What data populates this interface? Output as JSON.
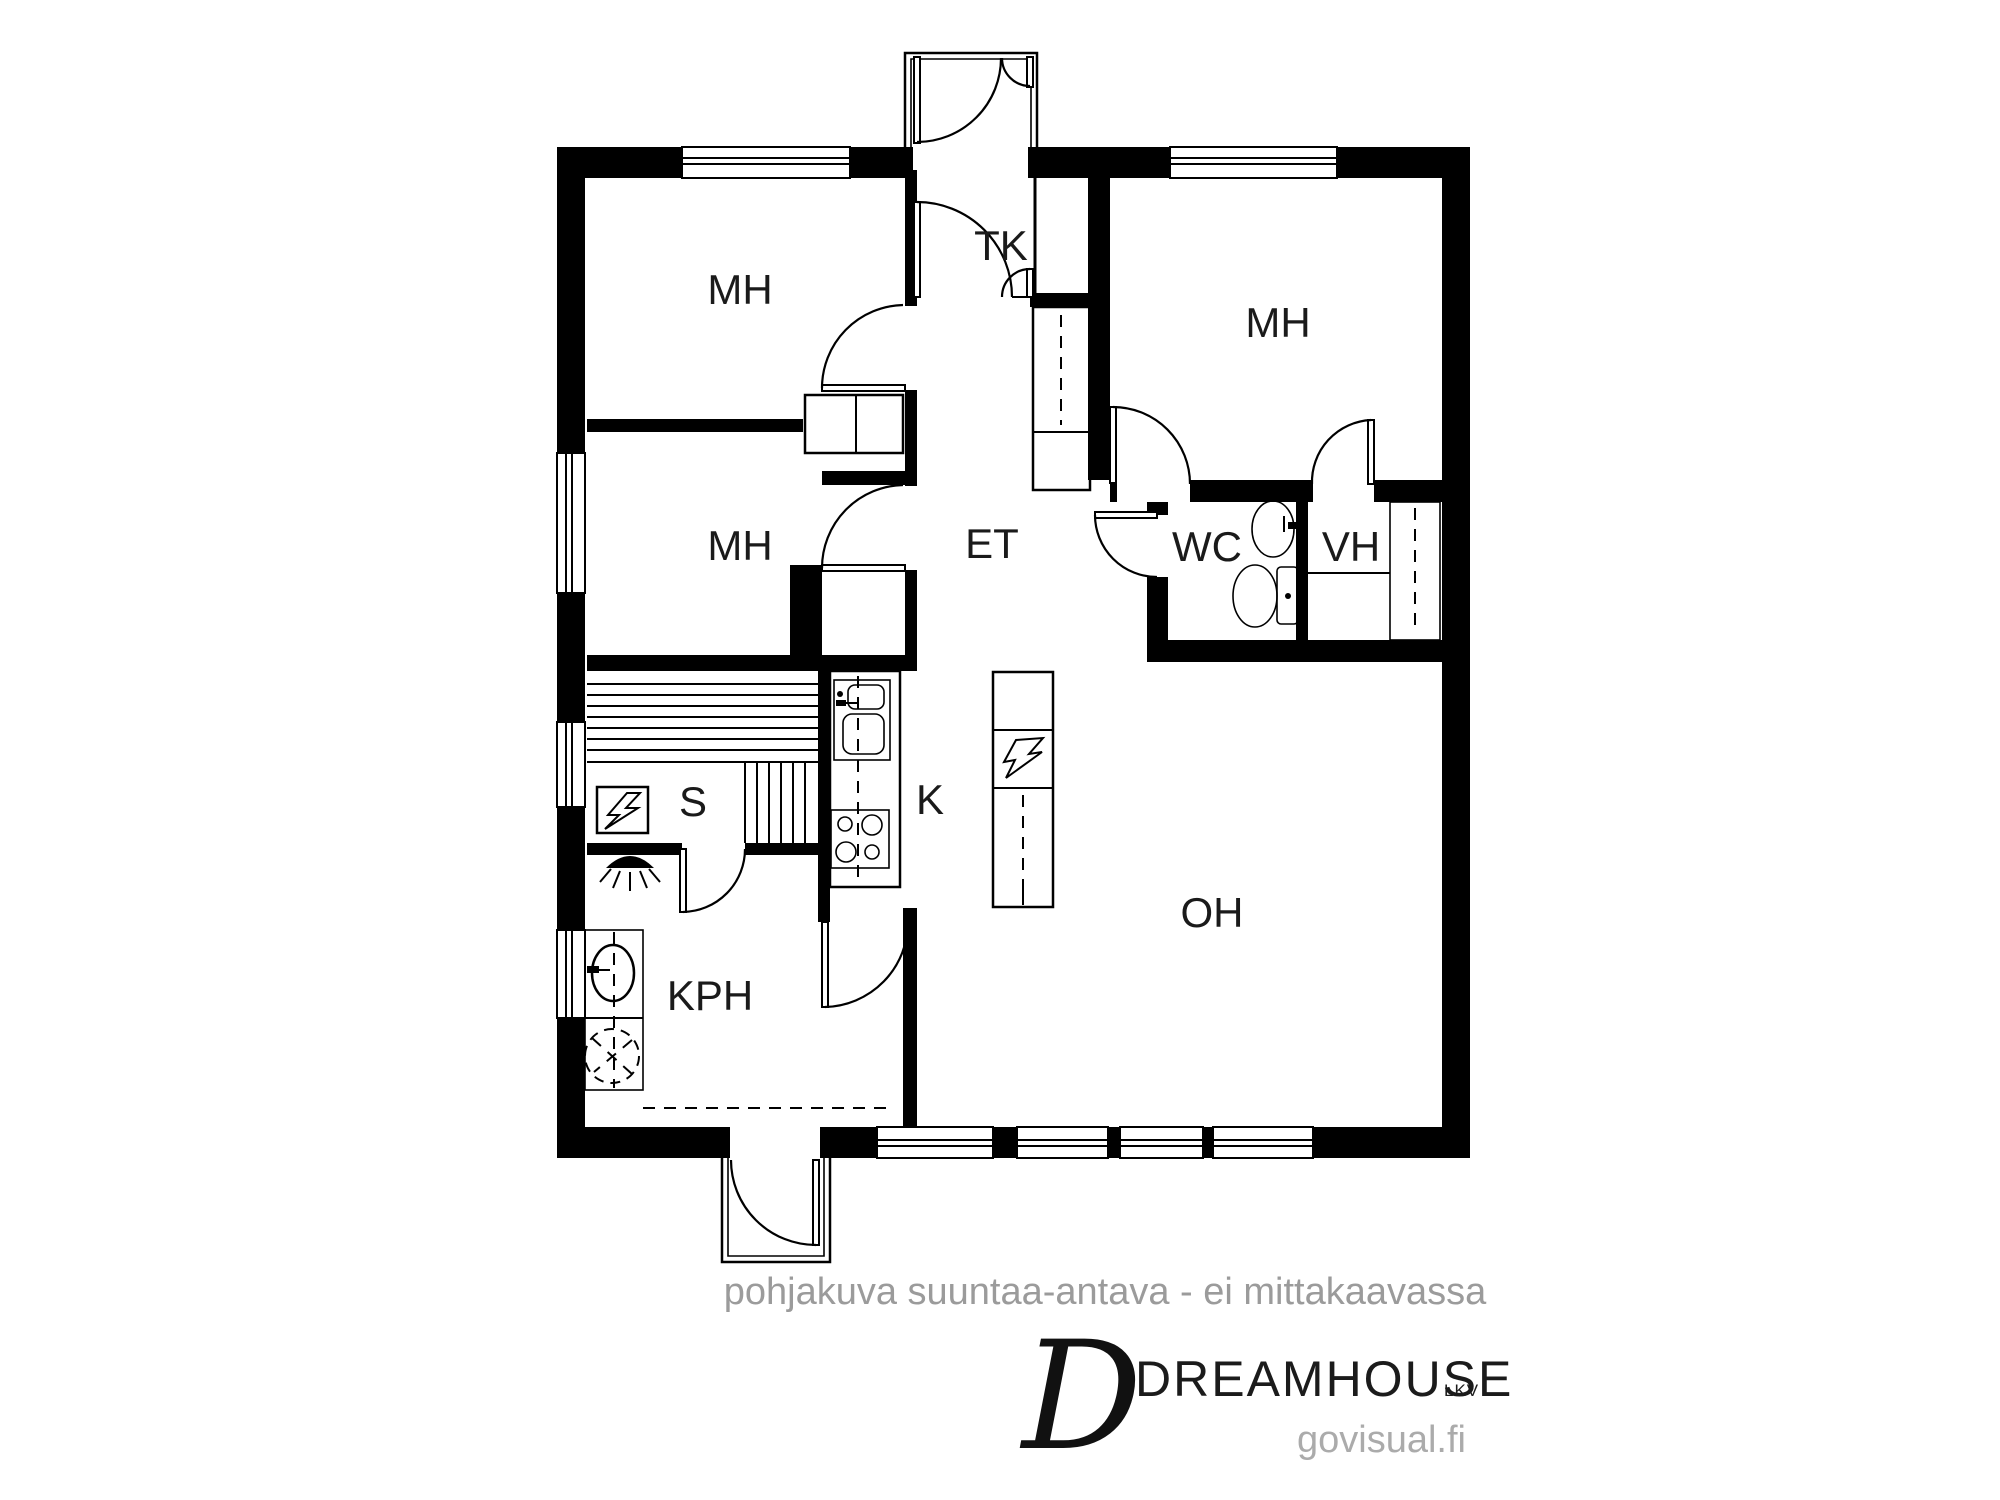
{
  "rooms": {
    "bedroom_top_left": "MH",
    "bedroom_mid_left": "MH",
    "bedroom_right": "MH",
    "vestibule": "TK",
    "entry_hall": "ET",
    "toilet": "WC",
    "closet_room": "VH",
    "sauna": "S",
    "kitchen": "K",
    "bathroom": "KPH",
    "living_room": "OH"
  },
  "footer": {
    "disclaimer": "pohjakuva suuntaa-antava - ei mittakaavassa",
    "logo_initial": "D",
    "brand": "DREAMHOUSE",
    "brand_suffix": "LKV",
    "website": "govisual.fi"
  },
  "icons": {
    "sauna_heater": "lightning-bolt-in-box",
    "fireplace": "lightning-bolt-in-box",
    "shower": "shower-head",
    "washing_machine": "dashed-circle",
    "bathroom_sink": "oval-basin",
    "wc_sink": "oval-basin",
    "toilet_seat": "bowl-with-cistern",
    "kitchen_sink": "double-basin",
    "stove": "four-burners"
  },
  "colors": {
    "wall": "#000000",
    "label": "#1a1a1a",
    "muted_text": "#9b9b9b"
  }
}
